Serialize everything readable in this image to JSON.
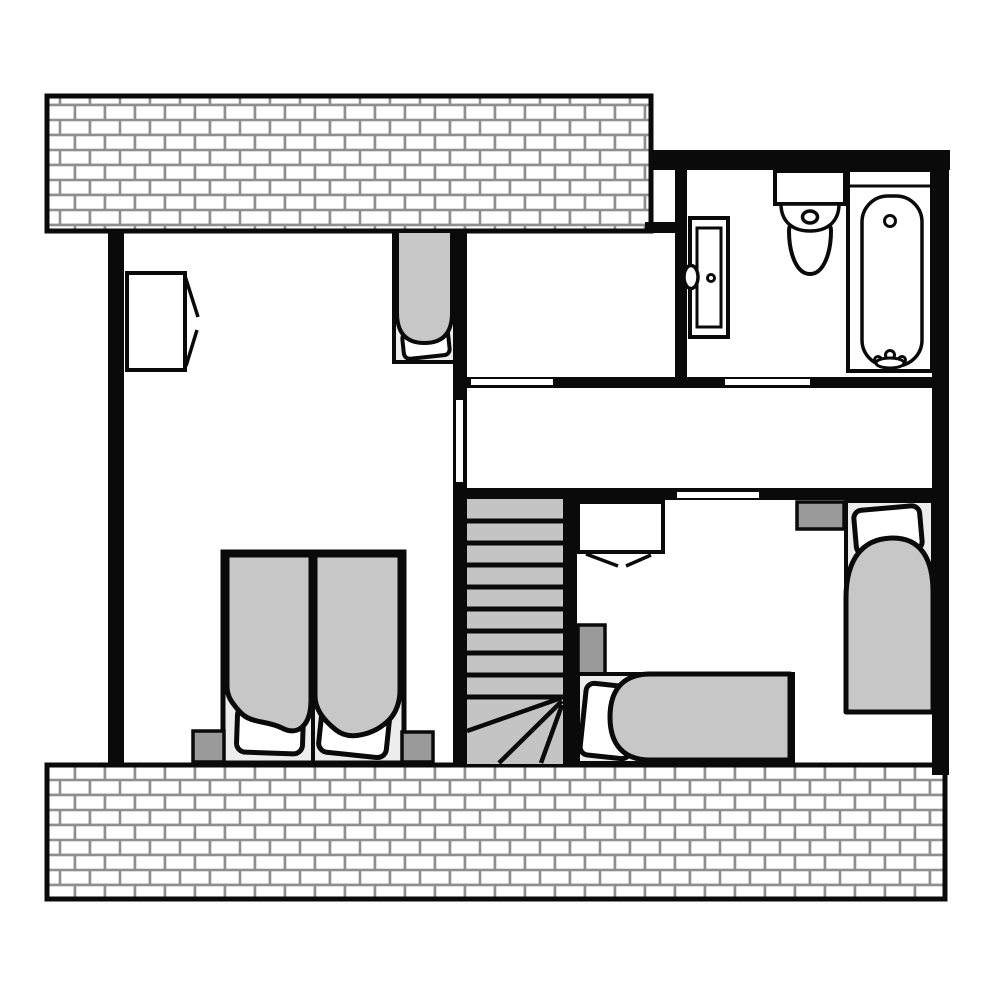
{
  "colors": {
    "wall": "#0a0a0a",
    "outline": "#0a0a0a",
    "floor": "#ffffff",
    "brick_fill": "#ffffff",
    "brick_mortar": "#8f8f8f",
    "duvet": "#c7c7c7",
    "bed_base": "#ededed",
    "nightstand": "#9a9a9a",
    "stairs": "#c4c4c4",
    "opening": "#ffffff",
    "fixture_fill": "#ffffff"
  },
  "plan": {
    "type": "architectural-floor-plan",
    "rooms": [
      {
        "name": "bedroom-left",
        "furniture": [
          "wardrobe",
          "cot-bed",
          "double-bed",
          "nightstand-left",
          "nightstand-right"
        ]
      },
      {
        "name": "room-top-middle",
        "furniture": []
      },
      {
        "name": "bathroom",
        "furniture": [
          "tall-cabinet",
          "toilet",
          "bathtub"
        ]
      },
      {
        "name": "hallway",
        "furniture": []
      },
      {
        "name": "bedroom-right",
        "furniture": [
          "wardrobe",
          "single-bed-vertical",
          "single-bed-horizontal",
          "nightstand-top",
          "nightstand-left"
        ]
      },
      {
        "name": "staircase",
        "straight_treads": 9,
        "winder_treads": 4
      }
    ],
    "door_openings": 4,
    "exterior_brick_walls": [
      "top-strip",
      "bottom-strip"
    ]
  }
}
